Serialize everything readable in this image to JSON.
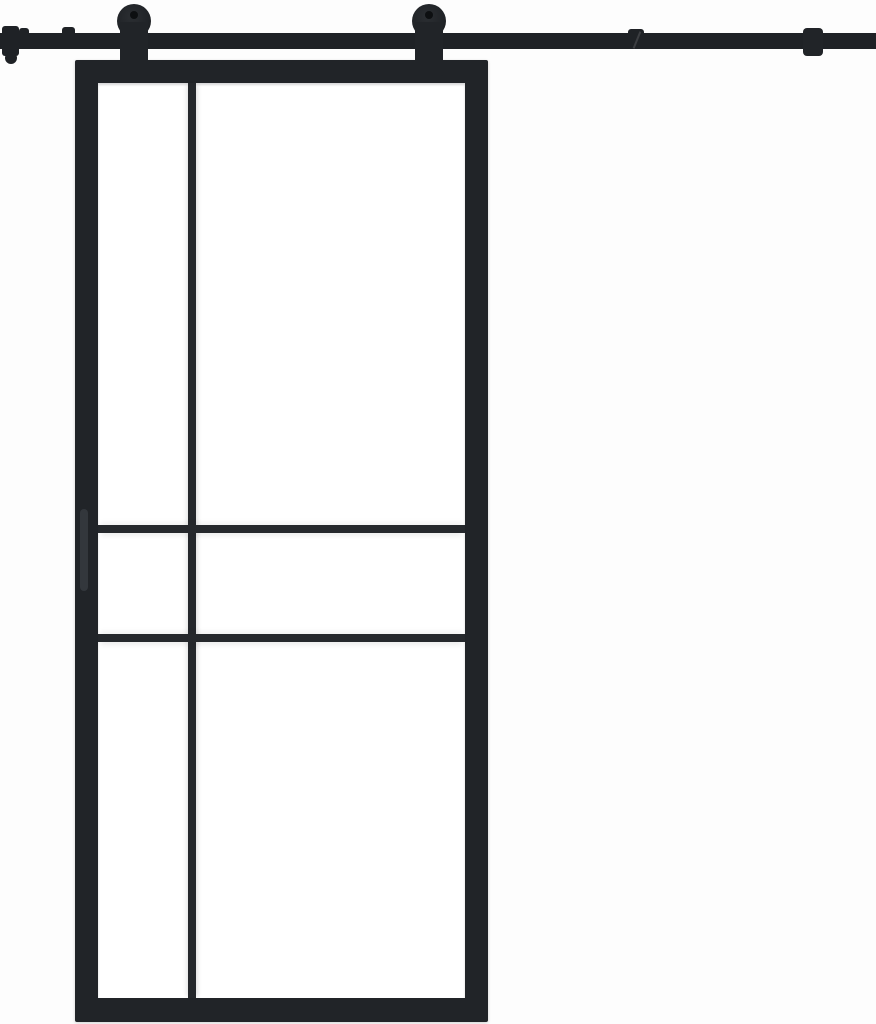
{
  "meta": {
    "subject": "Black steel-framed sliding barn door with six clear glass panes, hanging by two round roller wheels from a full-width top-mounted flat track, on a plain white background",
    "canvas": {
      "w": 876,
      "h": 1024
    }
  },
  "palette": {
    "bg": "#fdfdfd",
    "steel": "#212428",
    "rail": "#1f2226",
    "mullion": "#25282c",
    "handle": "#33373c",
    "hub": "#0d0f11",
    "glass": "#ffffff",
    "seam": "#53565a"
  },
  "track": {
    "rail": {
      "x": 0,
      "y": 33,
      "w": 876,
      "h": 16
    },
    "left_stop": {
      "x": 2,
      "y": 26,
      "w": 17,
      "h": 30
    },
    "left_stop_knob": {
      "x": 5,
      "y": 52,
      "w": 12,
      "h": 12
    },
    "bolt_a": {
      "x": 19,
      "y": 28,
      "w": 10,
      "h": 6
    },
    "bolt_b": {
      "x": 62,
      "y": 27,
      "w": 13,
      "h": 7
    },
    "seam_bump": {
      "x": 628,
      "y": 29,
      "w": 16,
      "h": 5
    },
    "seam_slash": {
      "x": 636,
      "y": 31,
      "w": 2,
      "h": 18
    },
    "mount_bracket": {
      "x": 803,
      "y": 28,
      "w": 20,
      "h": 28
    }
  },
  "rollers": [
    {
      "wheel": {
        "cx": 134,
        "cy": 21,
        "r": 17
      },
      "hub": {
        "cx": 134,
        "cy": 15,
        "r": 4
      },
      "strap": {
        "x": 120,
        "y": 22,
        "w": 28,
        "h": 54
      }
    },
    {
      "wheel": {
        "cx": 429,
        "cy": 21,
        "r": 17
      },
      "hub": {
        "cx": 429,
        "cy": 15,
        "r": 4
      },
      "strap": {
        "x": 415,
        "y": 22,
        "w": 28,
        "h": 54
      }
    }
  ],
  "door": {
    "slab": {
      "x": 75,
      "y": 60,
      "w": 413,
      "h": 962
    },
    "glass": {
      "x": 98,
      "y": 83,
      "w": 367,
      "h": 915
    },
    "mullion_vertical": {
      "x": 188,
      "y": 83,
      "w": 8,
      "h": 915
    },
    "mullion_horizontal_upper": {
      "x": 98,
      "y": 525,
      "w": 367,
      "h": 8
    },
    "mullion_horizontal_lower": {
      "x": 98,
      "y": 634,
      "w": 367,
      "h": 8
    },
    "handle": {
      "x": 80,
      "y": 509,
      "w": 8,
      "h": 82
    }
  }
}
